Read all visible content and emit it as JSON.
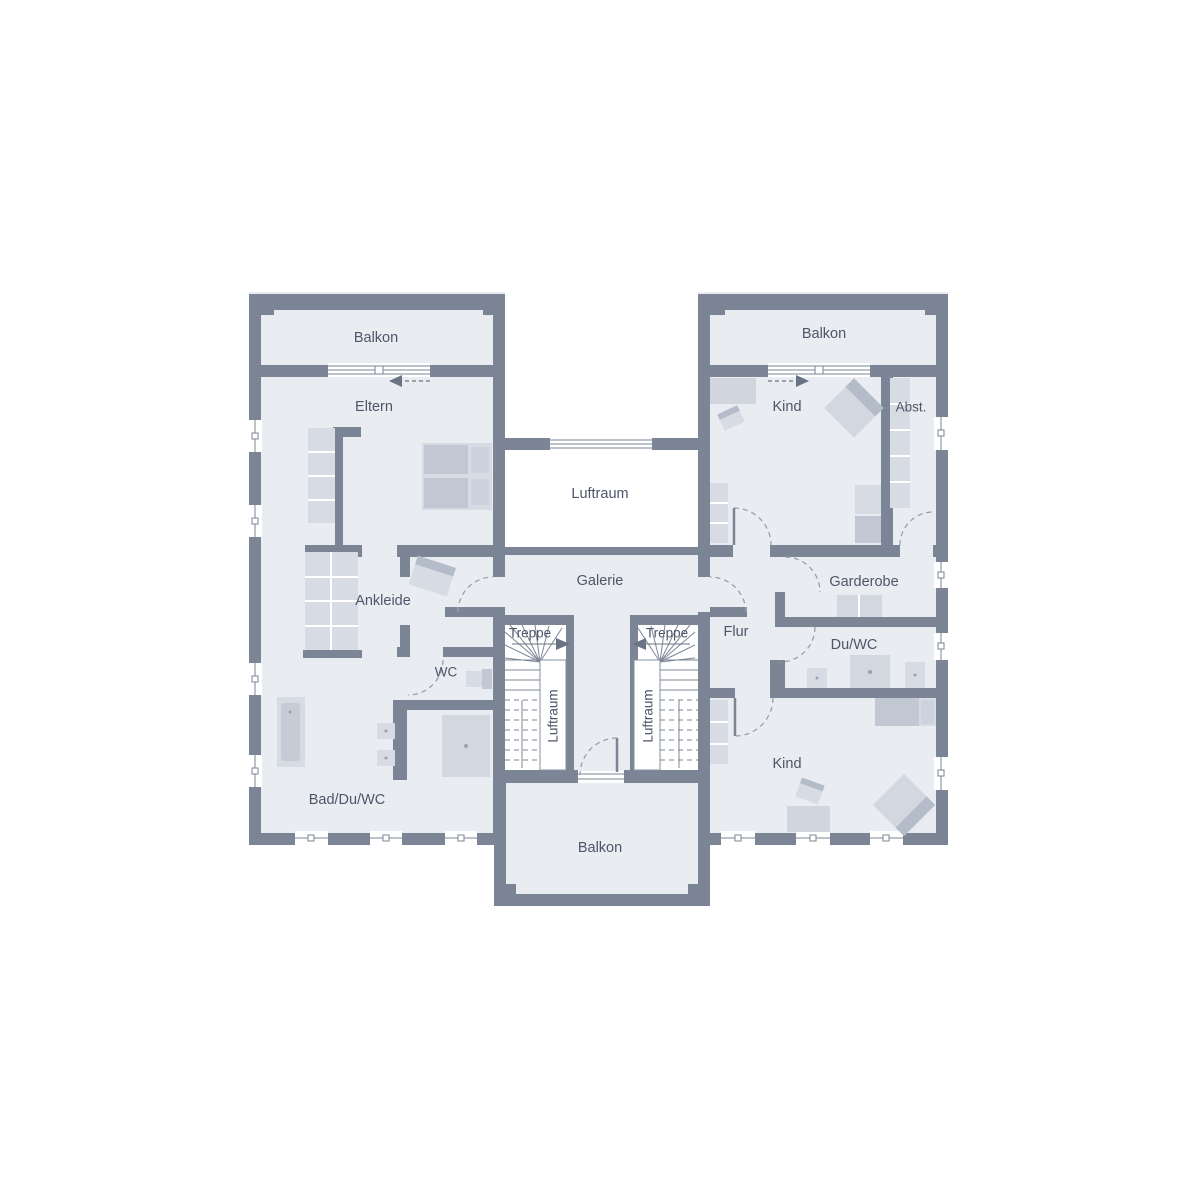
{
  "floorplan": {
    "rooms": {
      "balkon_top_left": "Balkon",
      "balkon_top_right": "Balkon",
      "balkon_bottom": "Balkon",
      "eltern": "Eltern",
      "kind_top": "Kind",
      "kind_bottom": "Kind",
      "abstellraum": "Abst.",
      "luftraum_center": "Luftraum",
      "luftraum_stair_left": "Luftraum",
      "luftraum_stair_right": "Luftraum",
      "galerie": "Galerie",
      "ankleide": "Ankleide",
      "garderobe": "Garderobe",
      "treppe_left": "Treppe",
      "treppe_right": "Treppe",
      "flur": "Flur",
      "wc": "WC",
      "du_wc": "Du/WC",
      "bad_du_wc": "Bad/Du/WC"
    },
    "colors": {
      "wall": "#7b8595",
      "room_fill": "#e9edf2",
      "void_fill": "#ffffff",
      "furniture_light": "#d7dbe3",
      "furniture_medium": "#c2c8d3",
      "furniture_accent": "#aeb5c3",
      "label_text": "#4d5668",
      "thin_line": "#8691a1"
    }
  }
}
